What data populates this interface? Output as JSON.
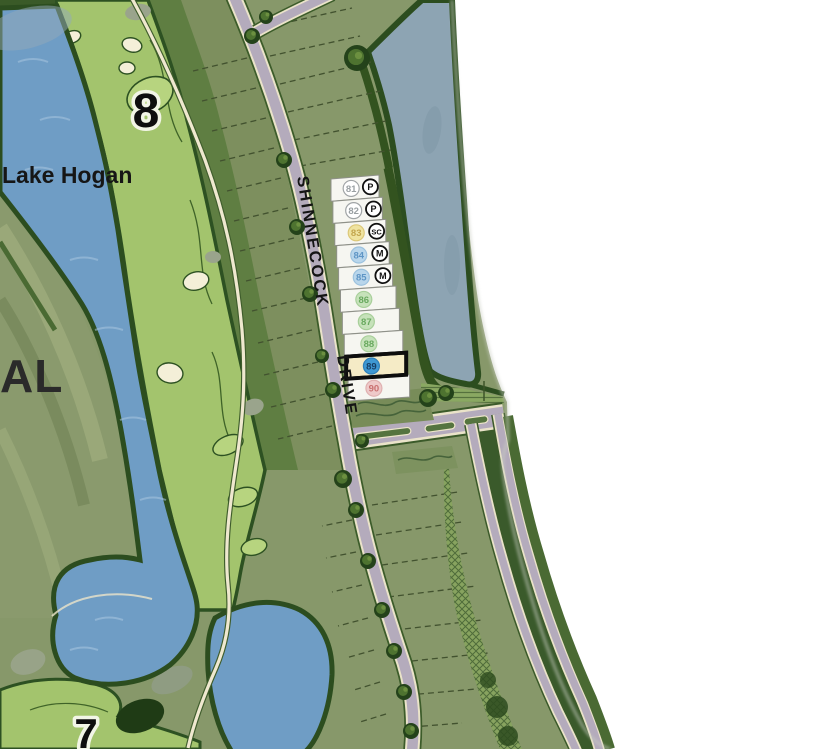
{
  "map": {
    "labels": {
      "lake_name": "Lake Hogan",
      "hole_number_top": "8",
      "hole_number_bottom": "7",
      "edge_label_partial": "AL",
      "street_word_1": "SHINNECOCK",
      "street_word_2": "DRIVE"
    },
    "selected_lot": "89",
    "lots": [
      {
        "number": "81",
        "badge": "P",
        "circle_fill": "#ffffff",
        "circle_ring": "#a0a4a6",
        "number_color": "#9aa0a3",
        "selected": false
      },
      {
        "number": "82",
        "badge": "P",
        "circle_fill": "#ffffff",
        "circle_ring": "#a0a4a6",
        "number_color": "#9aa0a3",
        "selected": false
      },
      {
        "number": "83",
        "badge": "SC",
        "circle_fill": "#efe3a0",
        "circle_ring": "#dcc878",
        "number_color": "#c3a64e",
        "selected": false
      },
      {
        "number": "84",
        "badge": "M",
        "circle_fill": "#b9d6eb",
        "circle_ring": "#9cc2de",
        "number_color": "#5e95c5",
        "selected": false
      },
      {
        "number": "85",
        "badge": "M",
        "circle_fill": "#b9d6eb",
        "circle_ring": "#9cc2de",
        "number_color": "#5e95c5",
        "selected": false
      },
      {
        "number": "86",
        "badge": null,
        "circle_fill": "#c6e2ba",
        "circle_ring": "#a8cf9a",
        "number_color": "#69a95f",
        "selected": false
      },
      {
        "number": "87",
        "badge": null,
        "circle_fill": "#c6e2ba",
        "circle_ring": "#a8cf9a",
        "number_color": "#69a95f",
        "selected": false
      },
      {
        "number": "88",
        "badge": null,
        "circle_fill": "#c6e2ba",
        "circle_ring": "#a8cf9a",
        "number_color": "#69a95f",
        "selected": false
      },
      {
        "number": "89",
        "badge": null,
        "circle_fill": "#3e98d3",
        "circle_ring": "#2f7fb8",
        "number_color": "#173f66",
        "selected": true
      },
      {
        "number": "90",
        "badge": null,
        "circle_fill": "#eec9c9",
        "circle_ring": "#dfb0b0",
        "number_color": "#c97070",
        "selected": false
      }
    ],
    "colors": {
      "selected_lot_outline": "#0d0d0d",
      "selected_lot_fill": "#f5ebc6",
      "lot_fill": "#f6f6f1",
      "lot_border": "#8f9189",
      "badge_ring": "#101010",
      "badge_fill": "#ffffff",
      "badge_text": "#101010",
      "road_pavement": "#b4abbc",
      "road_edge": "#eae3c9",
      "water_lake_hogan": "#6f9dc5",
      "water_north_lake": "#8da4b3",
      "fairway_green": "#a3c46d",
      "rough_green": "#5f7e42",
      "lot_ground": "#87986a",
      "tree_dark": "#24421a",
      "tree_light": "#4e7330"
    }
  }
}
